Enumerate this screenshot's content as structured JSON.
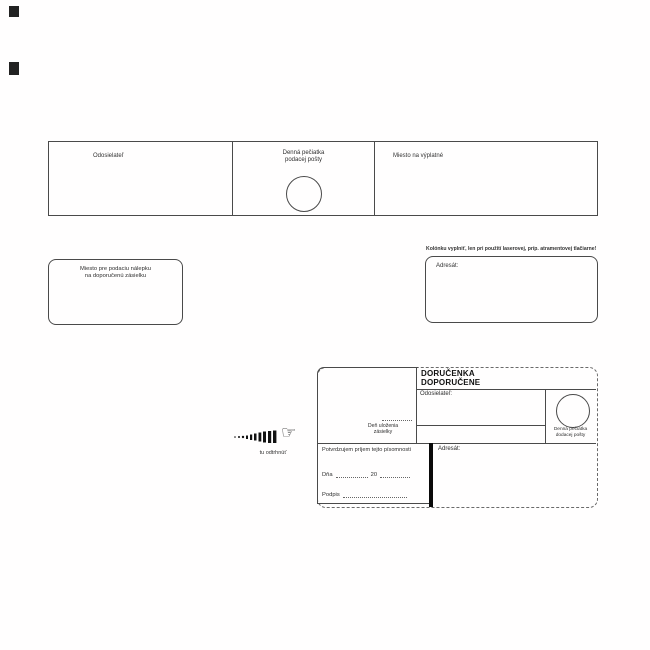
{
  "top_strip": {
    "sender_label": "Odosielateľ",
    "stamp_label_1": "Denná pečiatka",
    "stamp_label_2": "podacej pošty",
    "postage_label": "Miesto na výplatné"
  },
  "registered_label_box": {
    "line1": "Miesto pre podaciu nálepku",
    "line2": "na doporučenú zásielku"
  },
  "addressee_panel": {
    "note": "Kolónku vyplniť, len pri použití laserovej, príp. atramentovej tlačiarne!",
    "addressee_label": "Adresát:"
  },
  "tear_off": {
    "label": "tu odtrhnúť",
    "hand_icon": "☞"
  },
  "delivery_receipt": {
    "title_1": "DORUČENKA",
    "title_2": "DOPORUČENE",
    "sender_label": "Odosielateľ:",
    "storage_day_1": "Deň uloženia",
    "storage_day_2": "zásielky",
    "stamp_label_1": "Denná pečiatka",
    "stamp_label_2": "dodacej pošty",
    "confirm_text": "Potvrdzujem príjem tejto písomnosti",
    "date_label": "Dňa",
    "year_prefix": "20",
    "signature_label": "Podpis",
    "addressee_label": "Adresát:"
  }
}
